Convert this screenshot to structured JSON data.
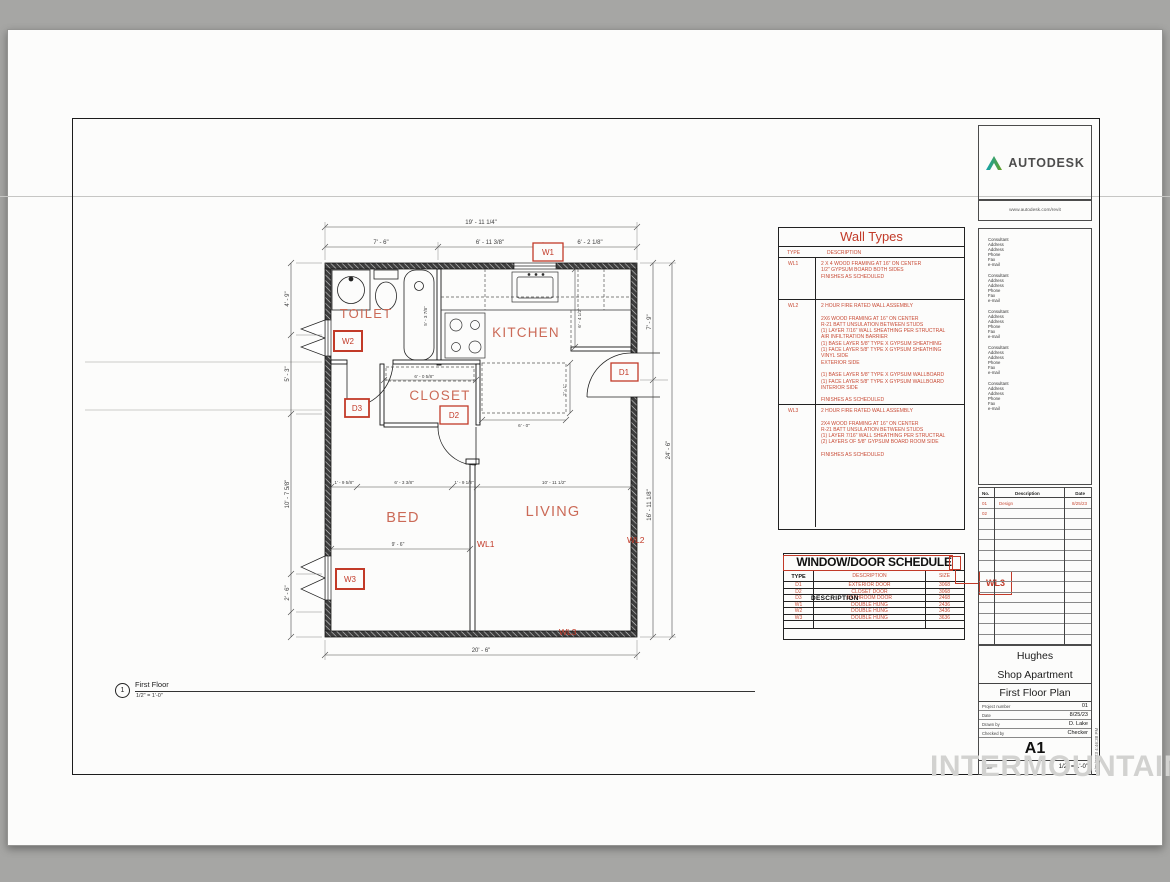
{
  "watermark": "INTERMOUNTAIN",
  "plan": {
    "rooms": {
      "toilet": "TOILET",
      "kitchen": "KITCHEN",
      "closet": "CLOSET",
      "bed": "BED",
      "living": "LIVING"
    },
    "wall_labels": {
      "wl1": "WL1",
      "wl2": "WL2",
      "wl3": "WL3"
    },
    "tags": {
      "w1": "W1",
      "w2": "W2",
      "w3": "W3",
      "d1": "D1",
      "d2": "D2",
      "d3": "D3"
    },
    "dims": {
      "top_overall": "19' - 11 1/4\"",
      "top_a": "7' - 6\"",
      "top_b": "6' - 11 3/8\"",
      "top_c": "6' - 2 1/8\"",
      "bottom_overall": "20' - 6\"",
      "left_a": "4' - 9\"",
      "left_b": "5' - 3\"",
      "left_c": "10' - 7 5/8\"",
      "left_d": "2' - 6\"",
      "right_a": "7' - 9\"",
      "right_b": "16' - 11 1/8\"",
      "right_overall": "24' - 6\"",
      "bed_a": "1' - 9 5/8\"",
      "bed_b": "6' - 3 3/8\"",
      "bed_c": "1' - 9 1/2\"",
      "living_a": "10' - 11 1/2\"",
      "bed_width": "9' - 6\"",
      "closet_width": "6' - 0 5/8\"",
      "island_width": "6' - 0\"",
      "island_depth": "2' - 1\"",
      "kitchen_depth": "6' - 4 1/2\"",
      "tub_length": "5' - 3 7/8\""
    },
    "view_title": {
      "number": "1",
      "name": "First Floor",
      "scale": "1/2\" = 1'-0\""
    }
  },
  "wall_types": {
    "title": "Wall Types",
    "headers": {
      "type": "TYPE",
      "description": "DESCRIPTION"
    },
    "rows": [
      {
        "type": "WL1",
        "text": "2 X 4 WOOD FRAMING AT 16\" ON CENTER\n1/2\" GYPSUM BOARD BOTH SIDES\nFINISHES AS SCHEDULED"
      },
      {
        "type": "WL2",
        "text": "2 HOUR FIRE RATED WALL ASSEMBLY\n\n2X6 WOOD FRAMING AT 16\" ON CENTER\nR-21 BATT UNSULATION BETWEEN STUDS\n(1) LAYER 7/16\" WALL SHEATHING PER STRUCTRAL\nAIR INFILTRATION BARRIER\n(1) BASE LAYER 5/8\" TYPE X GYPSUM SHEATHING\n(1) FACE LAYER 5/8\" TYPE X GYPSUM SHEATHING\nVINYL SIDE\nEXTERIOR SIDE\n\n(1) BASE LAYER 5/8\" TYPE X GYPSUM WALLBOARD\n(1) FACE LAYER 5/8\" TYPE X GYPSUM WALLBOARD\nINTERIOR SIDE\n\nFINISHES AS SCHEDULED"
      },
      {
        "type": "WL3",
        "text": "2 HOUR FIRE RATED WALL ASSEMBLY\n\n2X4 WOOD FRAMING AT 16\" ON CENTER\nR-21 BATT UNSULATION BETWEEN STUDS\n(1) LAYER 7/16\" WALL SHEATHING PER STRUCTRAL\n(2) LAYERS OF 5/8\" GYPSUM BOARD ROOM SIDE\n\nFINISHES AS SCHEDULED"
      }
    ]
  },
  "schedule": {
    "title": "WINDOW/DOOR SCHEDULE",
    "headers": {
      "type": "TYPE",
      "description": "DESCRIPTION",
      "size": "SIZE"
    },
    "overlap_text": "DESCRIPTION",
    "callout": "WL3",
    "rows": [
      {
        "type": "D1",
        "description": "EXTERIOR DOOR",
        "size": "3068"
      },
      {
        "type": "D2",
        "description": "CLOSET DOOR",
        "size": "3068"
      },
      {
        "type": "D3",
        "description": "BATHROOM DOOR",
        "size": "2468"
      },
      {
        "type": "W1",
        "description": "DOUBLE HUNG",
        "size": "2436"
      },
      {
        "type": "W2",
        "description": "DOUBLE HUNG",
        "size": "3436"
      },
      {
        "type": "W3",
        "description": "DOUBLE HUNG",
        "size": "3636"
      }
    ]
  },
  "title_block": {
    "brand": "AUTODESK",
    "brand_url": "www.autodesk.com/revit",
    "consultant_text": "Consultant\nAddress\nAddress\nPhone\nFax\ne-mail",
    "revisions": {
      "no_header": "No.",
      "desc_header": "Description",
      "date_header": "Date",
      "rows": [
        {
          "no": "01",
          "description": "Design",
          "date": "8/25/23"
        },
        {
          "no": "02",
          "description": "",
          "date": ""
        }
      ]
    },
    "owner": "Hughes",
    "project": "Shop Apartment",
    "sheet_title": "First Floor Plan",
    "fields": [
      {
        "label": "Project number",
        "value": "01"
      },
      {
        "label": "Date",
        "value": "8/25/23"
      },
      {
        "label": "Drawn by",
        "value": "D. Lake"
      },
      {
        "label": "Checked by",
        "value": "Checker"
      }
    ],
    "sheet_number": "A1",
    "scale_label": "Scale",
    "scale_value": "1/2\" = 1'-0\"",
    "plot_stamp": "8/25/2023 4:46:38 PM"
  }
}
